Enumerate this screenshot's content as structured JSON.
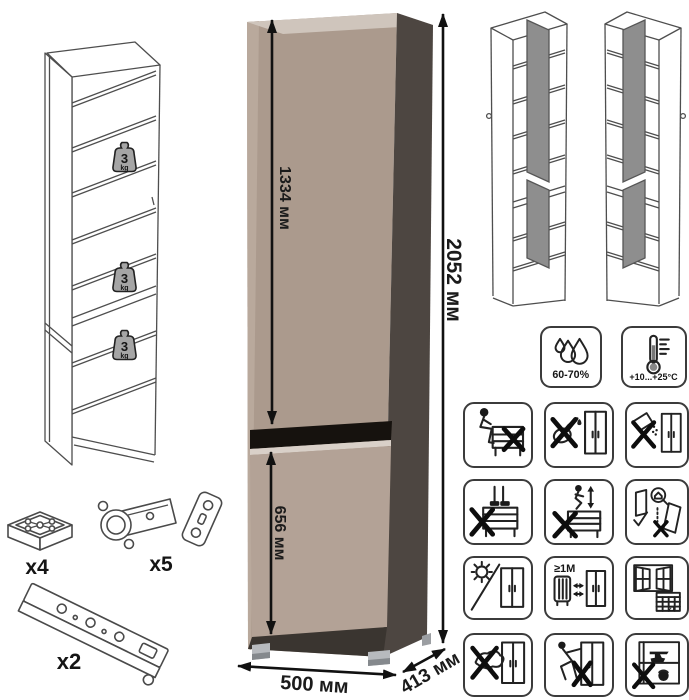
{
  "dimensions": {
    "upper_door_height": "1334 мм",
    "lower_door_height": "656 мм",
    "total_height": "2052 мм",
    "width": "500 мм",
    "depth": "413 мм"
  },
  "shelf_load": {
    "value": "3",
    "unit": "kg"
  },
  "hardware": {
    "foot": {
      "count_label": "x4"
    },
    "hinge": {
      "count_label": "x5"
    },
    "rail": {
      "count_label": "x2"
    }
  },
  "climate": {
    "humidity_range": "60-70%",
    "temperature_range": "+10...+25°C"
  },
  "care": {
    "min_heat_distance": "≥1M",
    "calendar_day": "21",
    "icons": [
      {
        "name": "humidity-icon",
        "label": "60-70%"
      },
      {
        "name": "temperature-icon",
        "label": "+10...+25°C"
      },
      {
        "name": "no-sitting-icon"
      },
      {
        "name": "no-watering-icon"
      },
      {
        "name": "no-spilling-icon"
      },
      {
        "name": "no-standing-icon"
      },
      {
        "name": "no-jumping-icon"
      },
      {
        "name": "anchor-to-wall-icon"
      },
      {
        "name": "no-direct-sunlight-icon"
      },
      {
        "name": "heat-distance-icon",
        "label": "≥1M"
      },
      {
        "name": "ventilation-icon",
        "label": "21"
      },
      {
        "name": "no-wet-cloth-icon"
      },
      {
        "name": "no-dragging-icon"
      },
      {
        "name": "no-overload-icon"
      }
    ]
  },
  "colors": {
    "cabinet_front": "#ab9a8d",
    "cabinet_front_lower": "#b3a296",
    "cabinet_top": "#cfc5bc",
    "cabinet_side": "#4d4641",
    "door_gap": "#16120e",
    "base_shadow": "#3a3530",
    "variant_door": "#8e8e8e",
    "weight_badge": "#a5a5a5"
  }
}
